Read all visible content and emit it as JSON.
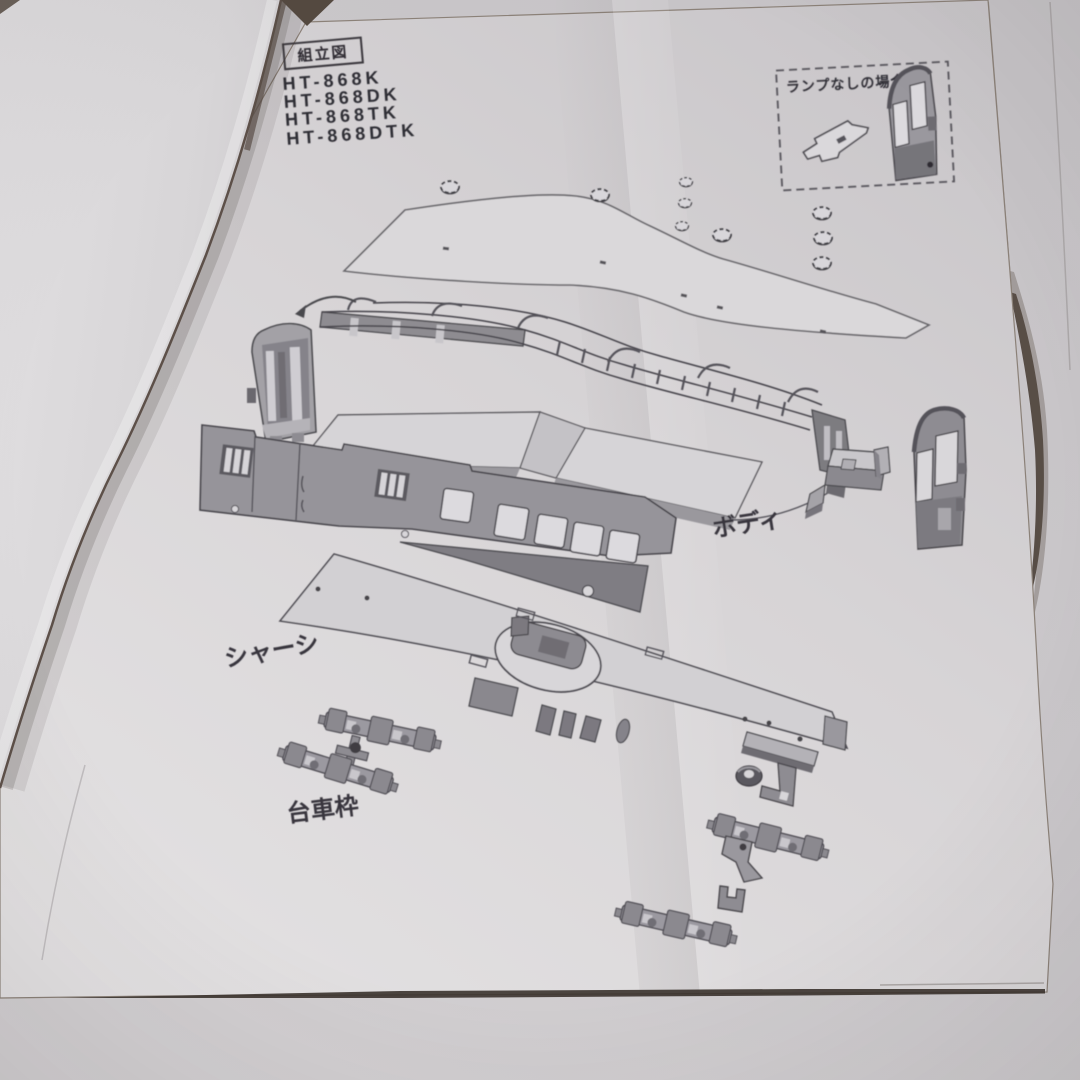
{
  "sheet": {
    "header_box_label": "組立図",
    "model_numbers": [
      "HT-868K",
      "HT-868DK",
      "HT-868TK",
      "HT-868DTK"
    ],
    "lamp_note": "ランプなしの場合",
    "part_labels": {
      "body": "ボディ",
      "chassis": "シャーシ",
      "bogie_frame": "台車枠"
    }
  },
  "colors": {
    "paper": "#d6d3d5",
    "left_paper": "#dcdadc",
    "background": "#c9c6c9",
    "ink": "#3a383e",
    "panel_gray": "#96949a",
    "panel_dark": "#7c7a80",
    "opening_light": "#dcdade",
    "shadow_brown": "#4a3f37"
  }
}
